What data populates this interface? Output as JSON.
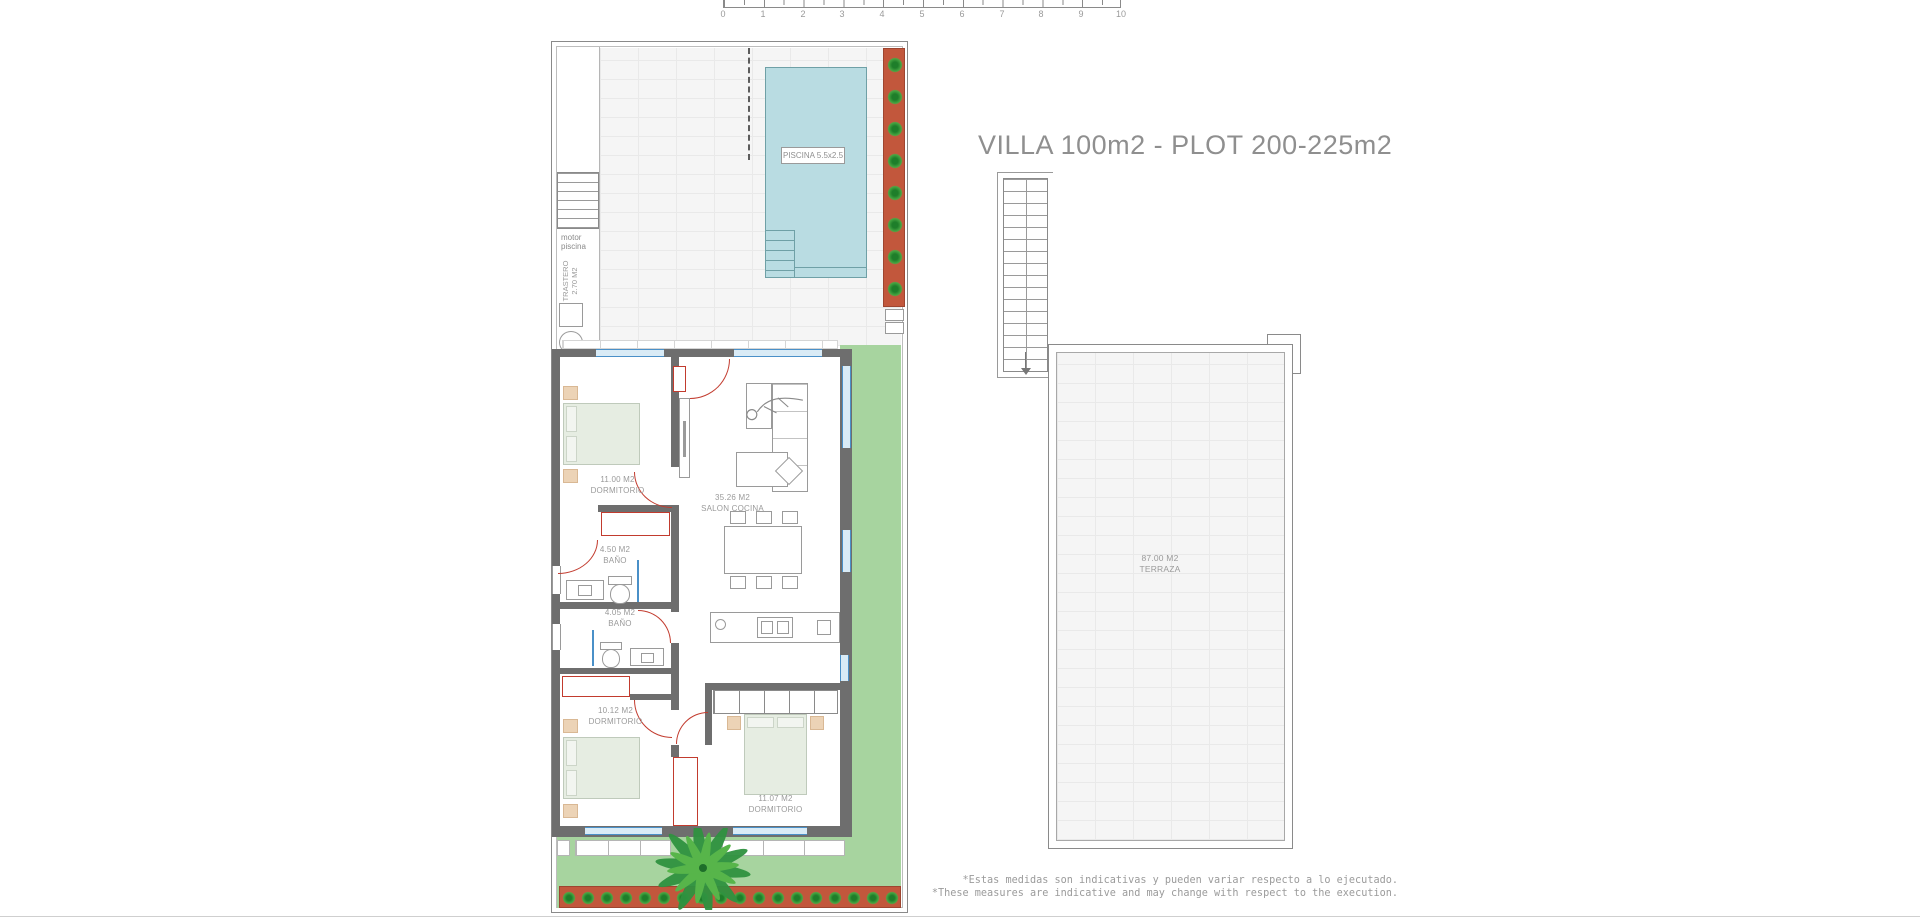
{
  "page": {
    "title": "VILLA 100m2 - PLOT 200-225m2"
  },
  "scale_bar": {
    "unit_labels": [
      "0",
      "1",
      "2",
      "3",
      "4",
      "5",
      "6",
      "7",
      "8",
      "9",
      "10"
    ]
  },
  "ground_floor_plan": {
    "pool": {
      "label": "PISCINA 5.5x2.5"
    },
    "pool_motor": {
      "line1": "motor",
      "line2": "piscina"
    },
    "storage": {
      "name": "TRASTERO",
      "area": "2.70 M2"
    },
    "rooms": [
      {
        "area": "11.00 M2",
        "name": "DORMITORIO"
      },
      {
        "area": "35.26 M2",
        "name": "SALON COCINA"
      },
      {
        "area": "4.50 M2",
        "name": "BAÑO"
      },
      {
        "area": "4.05 M2",
        "name": "BAÑO"
      },
      {
        "area": "10.12 M2",
        "name": "DORMITORIO"
      },
      {
        "area": "11.07 M2",
        "name": "DORMITORIO"
      }
    ]
  },
  "solarium_plan": {
    "room": {
      "area": "87.00 M2",
      "name": "TERRAZA"
    }
  },
  "footnotes": {
    "spanish": "*Estas medidas son indicativas y pueden variar respecto a lo ejecutado.",
    "english": "*These measures are indicative and may change with respect to the execution."
  },
  "colors": {
    "pool_water": "#b9dce2",
    "terracotta": "#c2573c",
    "grass": "#a7d49f",
    "wall": "#6e6e6e",
    "door": "#c23b2e",
    "window_frame": "#4a90c8",
    "label_text": "#9a9a9a"
  }
}
